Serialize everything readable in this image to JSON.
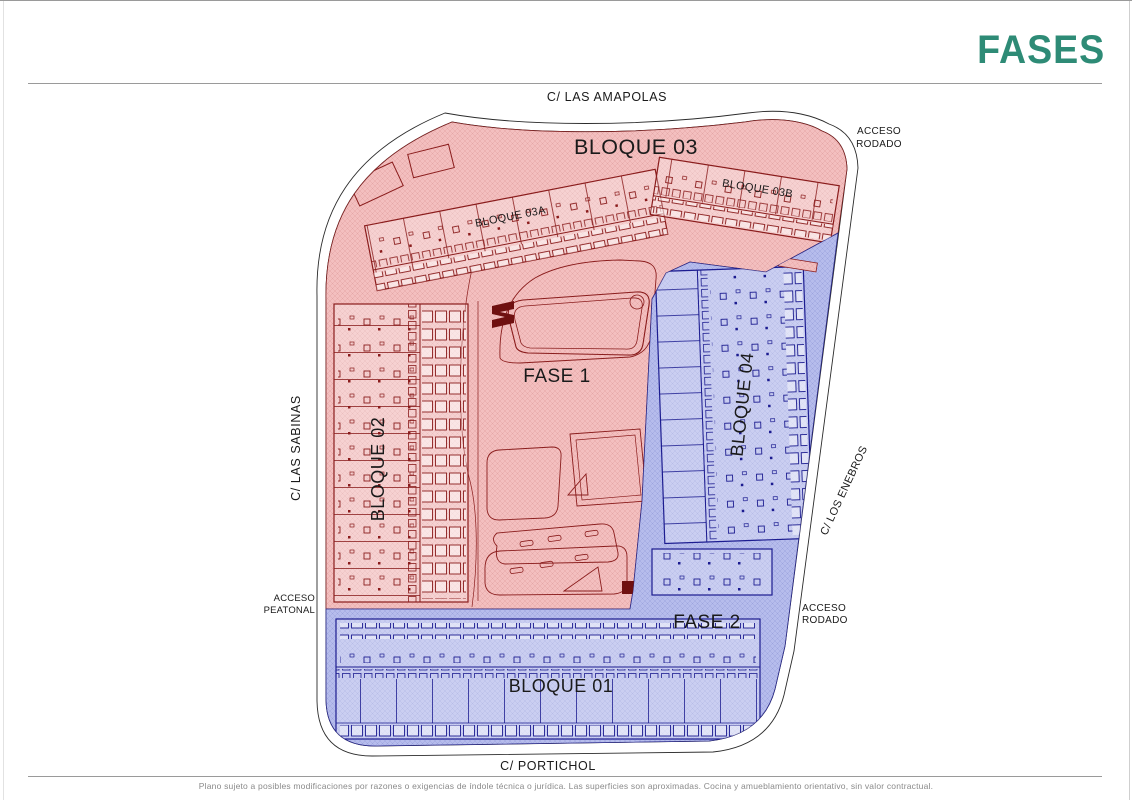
{
  "page": {
    "title": "FASES"
  },
  "colors": {
    "title": "#2e8b76",
    "fase1_fill": "#f3bfbf",
    "fase1_hatch": "#e2a4a4",
    "fase1_line": "#8a1c1c",
    "fase1_dark": "#6f1010",
    "fase2_fill": "#b6bcec",
    "fase2_hatch": "#98a0dc",
    "fase2_line": "#1c1c90",
    "outline": "#2b2b2b",
    "label": "#1a1a1a",
    "muted": "#8a8a8a"
  },
  "plan": {
    "streets": {
      "top": "C/ LAS AMAPOLAS",
      "left": "C/ LAS SABINAS",
      "right": "C/ LOS ENEBROS",
      "bottom": "C/ PORTICHOL"
    },
    "access_top": {
      "line1": "ACCESO",
      "line2": "RODADO"
    },
    "access_left": {
      "line1": "ACCESO",
      "line2": "PEATONAL"
    },
    "access_right": {
      "line1": "ACCESO",
      "line2": "RODADO"
    },
    "phases": {
      "fase1": "FASE 1",
      "fase2": "FASE 2"
    },
    "blocks": {
      "b03": "BLOQUE 03",
      "b03a": "BLOQUE 03A",
      "b03b": "BLOQUE 03B",
      "b02": "BLOQUE 02",
      "b04": "BLOQUE 04",
      "b01": "BLOQUE 01"
    }
  },
  "footer": {
    "disclaimer": "Plano sujeto a posibles modificaciones por razones o exigencias de índole técnica o jurídica. Las superficies son aproximadas. Cocina y amueblamiento orientativo, sin valor contractual."
  }
}
